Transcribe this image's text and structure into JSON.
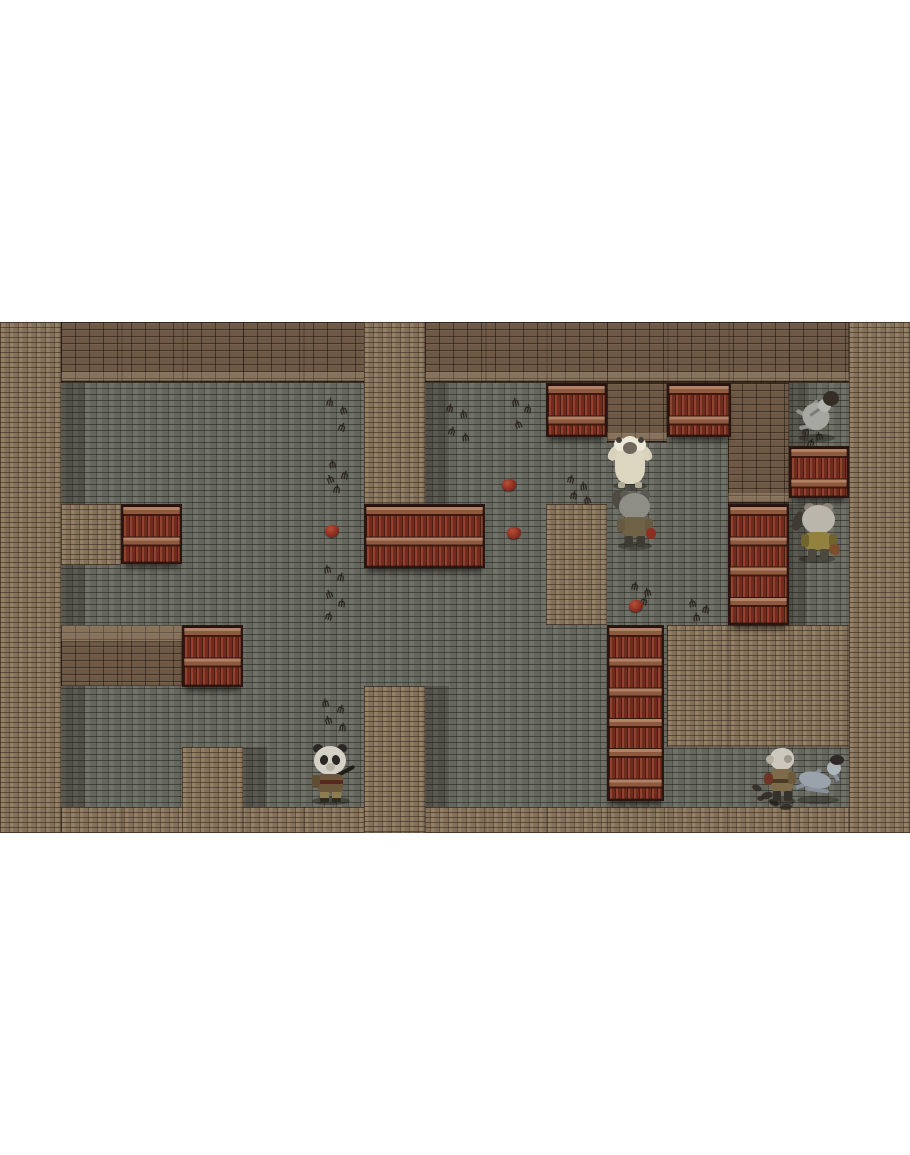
{
  "scene": {
    "letterbox_color": "#ffffff",
    "viewport": {
      "x": 0,
      "y": 322,
      "w": 910,
      "h": 511
    },
    "tile_size": 60.67
  },
  "palette": {
    "floor": "#6a6b62",
    "floor_mortar": "#45453f",
    "light_wall": "#8b775f",
    "dark_wall": "#6e5946",
    "shelf_plank": "#7e3526",
    "shelf_cap": "#b28266",
    "shelf_frame": "#2a1510",
    "blood_blob": "#8a2c1e",
    "footprint": "#27221b"
  },
  "map": {
    "tiles": [
      {
        "name": "border-left",
        "type": "light",
        "x": 0,
        "y": 0,
        "w": 60.7,
        "h": 511
      },
      {
        "name": "wall-top-band",
        "type": "dark",
        "cap": "bottom",
        "seams": true,
        "x": 60.7,
        "y": 0,
        "w": 788.6,
        "h": 60.7
      },
      {
        "name": "border-right",
        "type": "light",
        "x": 849.3,
        "y": 0,
        "w": 60.7,
        "h": 511
      },
      {
        "name": "border-bottom",
        "type": "light",
        "seams": true,
        "x": 60.7,
        "y": 485.3,
        "w": 788.6,
        "h": 25.7
      },
      {
        "name": "pillar-top-center",
        "type": "light",
        "x": 364,
        "y": 0,
        "w": 60.7,
        "h": 182
      },
      {
        "name": "wall-mid-top",
        "type": "dark",
        "cap": "bottom",
        "x": 606.7,
        "y": 60.7,
        "w": 60.7,
        "h": 60.6
      },
      {
        "name": "wall-right-top",
        "type": "dark",
        "cap": "bottom",
        "x": 728,
        "y": 60.7,
        "w": 60.7,
        "h": 121.3
      },
      {
        "name": "block-left-small",
        "type": "light",
        "x": 60.7,
        "y": 182,
        "w": 60.6,
        "h": 60.7
      },
      {
        "name": "pillar-center",
        "type": "light",
        "x": 546,
        "y": 182,
        "w": 60.7,
        "h": 121.3
      },
      {
        "name": "wall-left-band",
        "type": "dark",
        "cap": "top",
        "seams": true,
        "x": 60.7,
        "y": 303.3,
        "w": 121.3,
        "h": 60.7
      },
      {
        "name": "block-right-large",
        "type": "light",
        "seams": true,
        "x": 667.3,
        "y": 303.3,
        "w": 182,
        "h": 121.4
      },
      {
        "name": "pillar-bottom-center",
        "type": "light",
        "x": 364,
        "y": 364,
        "w": 60.7,
        "h": 147
      },
      {
        "name": "pillar-bottom-left",
        "type": "light",
        "x": 182,
        "y": 424.7,
        "w": 60.7,
        "h": 86.3
      },
      {
        "name": "shelf-top-a",
        "type": "shelf",
        "x": 546,
        "y": 60.7,
        "w": 60.7,
        "h": 54
      },
      {
        "name": "shelf-top-b",
        "type": "shelf",
        "x": 667.3,
        "y": 60.7,
        "w": 64,
        "h": 54
      },
      {
        "name": "shelf-right-corridor",
        "type": "shelf",
        "x": 788.7,
        "y": 124,
        "w": 60.6,
        "h": 52
      },
      {
        "name": "shelf-left-a",
        "type": "shelf",
        "x": 121.3,
        "y": 182,
        "w": 60.7,
        "h": 60
      },
      {
        "name": "shelf-mid-double",
        "type": "shelf",
        "x": 364,
        "y": 182,
        "w": 121.3,
        "h": 64
      },
      {
        "name": "shelf-left-b",
        "type": "shelf",
        "x": 182,
        "y": 303.3,
        "w": 60.7,
        "h": 62
      },
      {
        "name": "shelf-right-tall",
        "type": "shelf",
        "x": 728,
        "y": 182,
        "w": 60.7,
        "h": 121
      },
      {
        "name": "shelf-center-tall",
        "type": "shelf",
        "x": 606.7,
        "y": 303.3,
        "w": 57,
        "h": 176
      }
    ],
    "shadow_strips": [
      {
        "x": 60.7,
        "y": 60.7,
        "w": 24,
        "h": 424.6
      },
      {
        "x": 424.7,
        "y": 60.7,
        "w": 24,
        "h": 121.3
      },
      {
        "x": 424.7,
        "y": 364,
        "w": 24,
        "h": 147
      },
      {
        "x": 242.7,
        "y": 424.7,
        "w": 24,
        "h": 86.3
      },
      {
        "x": 788.7,
        "y": 60.7,
        "w": 20,
        "h": 63
      },
      {
        "x": 788.7,
        "y": 182,
        "w": 18,
        "h": 121
      }
    ]
  },
  "decals": {
    "footprint_glyph": "ψ",
    "footprints": [
      [
        326,
        76,
        10
      ],
      [
        340,
        84,
        -15
      ],
      [
        338,
        101,
        20
      ],
      [
        329,
        138,
        -5
      ],
      [
        341,
        149,
        15
      ],
      [
        327,
        153,
        -20
      ],
      [
        333,
        163,
        8
      ],
      [
        324,
        243,
        -10
      ],
      [
        337,
        251,
        12
      ],
      [
        326,
        268,
        -18
      ],
      [
        338,
        277,
        6
      ],
      [
        325,
        290,
        15
      ],
      [
        322,
        377,
        -8
      ],
      [
        337,
        383,
        14
      ],
      [
        325,
        394,
        -16
      ],
      [
        339,
        401,
        5
      ],
      [
        446,
        82,
        12
      ],
      [
        460,
        88,
        -10
      ],
      [
        448,
        105,
        18
      ],
      [
        462,
        111,
        -5
      ],
      [
        512,
        76,
        -12
      ],
      [
        524,
        83,
        10
      ],
      [
        515,
        98,
        -20
      ],
      [
        567,
        153,
        15
      ],
      [
        580,
        160,
        -8
      ],
      [
        570,
        169,
        12
      ],
      [
        584,
        174,
        -15
      ],
      [
        631,
        260,
        10
      ],
      [
        644,
        266,
        -12
      ],
      [
        640,
        275,
        18
      ],
      [
        689,
        277,
        -10
      ],
      [
        702,
        283,
        12
      ],
      [
        693,
        291,
        -6
      ],
      [
        802,
        105,
        8
      ],
      [
        816,
        110,
        -14
      ],
      [
        807,
        117,
        15
      ]
    ],
    "blobs": [
      [
        502,
        157
      ],
      [
        507,
        205
      ],
      [
        325,
        203
      ],
      [
        629,
        278
      ]
    ],
    "debris": [
      [
        752,
        463,
        10,
        6,
        20
      ],
      [
        761,
        470,
        12,
        7,
        -15
      ],
      [
        769,
        478,
        10,
        6,
        30
      ],
      [
        780,
        482,
        12,
        6,
        -5
      ],
      [
        757,
        474,
        7,
        5,
        0
      ]
    ]
  },
  "characters": [
    {
      "id": "sheep-monster",
      "x": 608,
      "y": 114,
      "w": 44,
      "h": 52,
      "parts": [
        {
          "n": "arm-left",
          "x": 1,
          "y": 10,
          "w": 10,
          "h": 15,
          "bg": "#d9d3bd",
          "r": "40%",
          "rot": 30
        },
        {
          "n": "arm-right",
          "x": 33,
          "y": 10,
          "w": 10,
          "h": 15,
          "bg": "#d9d3bd",
          "r": "40%",
          "rot": -30
        },
        {
          "n": "body",
          "x": 7,
          "y": 12,
          "w": 30,
          "h": 36,
          "bg": "#dcd6c0",
          "r": "34% 34% 42% 42%"
        },
        {
          "n": "mane-left",
          "x": 6,
          "y": 2,
          "w": 13,
          "h": 13,
          "bg": "#ece8d8",
          "r": "50%"
        },
        {
          "n": "mane-right",
          "x": 25,
          "y": 2,
          "w": 13,
          "h": 13,
          "bg": "#ece8d8",
          "r": "50%"
        },
        {
          "n": "mane-top",
          "x": 14,
          "y": 0,
          "w": 16,
          "h": 14,
          "bg": "#ece8d8",
          "r": "50%"
        },
        {
          "n": "ear-left",
          "x": 8,
          "y": 1,
          "w": 6,
          "h": 6,
          "bg": "#44403a",
          "r": "50%"
        },
        {
          "n": "ear-right",
          "x": 30,
          "y": 1,
          "w": 6,
          "h": 6,
          "bg": "#44403a",
          "r": "50%"
        },
        {
          "n": "face",
          "x": 15,
          "y": 6,
          "w": 14,
          "h": 12,
          "bg": "#6f665c",
          "r": "50%"
        },
        {
          "n": "foot-left",
          "x": 10,
          "y": 46,
          "w": 7,
          "h": 6,
          "bg": "#b3ac96",
          "r": "30%"
        },
        {
          "n": "foot-right",
          "x": 27,
          "y": 46,
          "w": 7,
          "h": 6,
          "bg": "#b3ac96",
          "r": "30%"
        }
      ]
    },
    {
      "id": "cat-villager-front",
      "x": 612,
      "y": 168,
      "w": 46,
      "h": 58,
      "parts": [
        {
          "n": "tail",
          "x": 0,
          "y": 0,
          "w": 15,
          "h": 20,
          "bg": "#4f4b42",
          "r": "50%",
          "rot": -20
        },
        {
          "n": "ear-left",
          "x": 8,
          "y": 0,
          "w": 10,
          "h": 10,
          "bg": "#5b5a52",
          "r": "50%"
        },
        {
          "n": "ear-right",
          "x": 28,
          "y": 0,
          "w": 10,
          "h": 10,
          "bg": "#5b5a52",
          "r": "50%"
        },
        {
          "n": "head",
          "x": 7,
          "y": 3,
          "w": 31,
          "h": 27,
          "bg": "#8e8d86",
          "r": "50%"
        },
        {
          "n": "body",
          "x": 10,
          "y": 27,
          "w": 26,
          "h": 20,
          "bg": "#6f6246",
          "r": "28%"
        },
        {
          "n": "arm-left",
          "x": 5,
          "y": 29,
          "w": 8,
          "h": 13,
          "bg": "#665a40",
          "r": "30%"
        },
        {
          "n": "arm-right",
          "x": 33,
          "y": 29,
          "w": 8,
          "h": 13,
          "bg": "#665a40",
          "r": "30%"
        },
        {
          "n": "pouch",
          "x": 34,
          "y": 38,
          "w": 10,
          "h": 11,
          "bg": "#8c3024",
          "r": "45%"
        },
        {
          "n": "leg-left",
          "x": 13,
          "y": 46,
          "w": 8,
          "h": 11,
          "bg": "#3e3b34",
          "r": "20%"
        },
        {
          "n": "leg-right",
          "x": 25,
          "y": 46,
          "w": 8,
          "h": 11,
          "bg": "#3e3b34",
          "r": "20%"
        }
      ]
    },
    {
      "id": "skeleton-north",
      "x": 793,
      "y": 68,
      "w": 48,
      "h": 50,
      "parts": [
        {
          "n": "limb-a",
          "x": 2,
          "y": 24,
          "w": 24,
          "h": 4,
          "bg": "#8f918b",
          "rot": 28,
          "r": "2px"
        },
        {
          "n": "limb-b",
          "x": 6,
          "y": 34,
          "w": 22,
          "h": 4,
          "bg": "#8f918b",
          "rot": -12,
          "r": "2px"
        },
        {
          "n": "limb-c",
          "x": 16,
          "y": 8,
          "w": 4,
          "h": 20,
          "bg": "#8f918b",
          "rot": 40,
          "r": "2px"
        },
        {
          "n": "body",
          "x": 10,
          "y": 13,
          "w": 26,
          "h": 27,
          "bg": "#a6a7a1",
          "r": "46%",
          "rot": -35
        },
        {
          "n": "rib-shade",
          "x": 16,
          "y": 20,
          "w": 14,
          "h": 3,
          "bg": "#7c7e78",
          "rot": -35
        },
        {
          "n": "skull",
          "x": 25,
          "y": 9,
          "w": 13,
          "h": 13,
          "bg": "#b4b4ae",
          "r": "50%"
        },
        {
          "n": "hair",
          "x": 30,
          "y": 1,
          "w": 16,
          "h": 15,
          "bg": "#362d27",
          "r": "50%"
        }
      ]
    },
    {
      "id": "cat-villager-east",
      "x": 793,
      "y": 181,
      "w": 48,
      "h": 58,
      "parts": [
        {
          "n": "tail",
          "x": 0,
          "y": 8,
          "w": 10,
          "h": 20,
          "bg": "#3f3b33",
          "r": "50%",
          "rot": 18
        },
        {
          "n": "ear-left",
          "x": 11,
          "y": 0,
          "w": 11,
          "h": 9,
          "bg": "#8b8378",
          "r": "50%"
        },
        {
          "n": "ear-right",
          "x": 29,
          "y": 0,
          "w": 11,
          "h": 9,
          "bg": "#8b8378",
          "r": "50%"
        },
        {
          "n": "head",
          "x": 9,
          "y": 2,
          "w": 33,
          "h": 29,
          "bg": "#bab6ac",
          "r": "50%"
        },
        {
          "n": "body",
          "x": 12,
          "y": 29,
          "w": 27,
          "h": 18,
          "bg": "#93813f",
          "r": "26%"
        },
        {
          "n": "arm-left",
          "x": 8,
          "y": 31,
          "w": 8,
          "h": 13,
          "bg": "#6f6330",
          "r": "30%"
        },
        {
          "n": "arm-right",
          "x": 36,
          "y": 31,
          "w": 8,
          "h": 13,
          "bg": "#6f6330",
          "r": "30%"
        },
        {
          "n": "pouch",
          "x": 36,
          "y": 41,
          "w": 11,
          "h": 11,
          "bg": "#7c4e2c",
          "r": "45%"
        },
        {
          "n": "leg-left",
          "x": 15,
          "y": 46,
          "w": 8,
          "h": 11,
          "bg": "#4c4840",
          "r": "20%"
        },
        {
          "n": "leg-right",
          "x": 27,
          "y": 46,
          "w": 8,
          "h": 11,
          "bg": "#4c4840",
          "r": "20%"
        }
      ]
    },
    {
      "id": "panda-gunner",
      "x": 306,
      "y": 422,
      "w": 50,
      "h": 59,
      "parts": [
        {
          "n": "ear-left",
          "x": 7,
          "y": 0,
          "w": 10,
          "h": 9,
          "bg": "#2b2724",
          "r": "50%"
        },
        {
          "n": "ear-right",
          "x": 31,
          "y": 0,
          "w": 10,
          "h": 9,
          "bg": "#2b2724",
          "r": "50%"
        },
        {
          "n": "head",
          "x": 8,
          "y": 2,
          "w": 32,
          "h": 29,
          "bg": "#d6d1c6",
          "r": "50%"
        },
        {
          "n": "eye-left",
          "x": 14,
          "y": 11,
          "w": 8,
          "h": 10,
          "bg": "#2b2724",
          "r": "50%",
          "rot": 12
        },
        {
          "n": "eye-right",
          "x": 26,
          "y": 11,
          "w": 8,
          "h": 10,
          "bg": "#2b2724",
          "r": "50%",
          "rot": -12
        },
        {
          "n": "muzzle",
          "x": 20,
          "y": 19,
          "w": 9,
          "h": 8,
          "bg": "#b9b3a6",
          "r": "50%"
        },
        {
          "n": "gun",
          "x": 22,
          "y": 27,
          "w": 28,
          "h": 4,
          "bg": "#201d19",
          "rot": -28,
          "r": "2px"
        },
        {
          "n": "body",
          "x": 12,
          "y": 30,
          "w": 25,
          "h": 19,
          "bg": "#6b583c",
          "r": "22%"
        },
        {
          "n": "strap",
          "x": 12,
          "y": 36,
          "w": 25,
          "h": 4,
          "bg": "#59281f"
        },
        {
          "n": "arm-left",
          "x": 6,
          "y": 31,
          "w": 8,
          "h": 13,
          "bg": "#5f4e34",
          "r": "30%"
        },
        {
          "n": "leg-left",
          "x": 14,
          "y": 48,
          "w": 9,
          "h": 7,
          "bg": "#8d7b51"
        },
        {
          "n": "leg-right",
          "x": 26,
          "y": 48,
          "w": 9,
          "h": 7,
          "bg": "#8d7b51"
        },
        {
          "n": "boot-left",
          "x": 14,
          "y": 54,
          "w": 9,
          "h": 5,
          "bg": "#2e2a26"
        },
        {
          "n": "boot-right",
          "x": 26,
          "y": 54,
          "w": 9,
          "h": 5,
          "bg": "#2e2a26"
        }
      ]
    },
    {
      "id": "goat-warrior",
      "x": 764,
      "y": 426,
      "w": 36,
      "h": 55,
      "parts": [
        {
          "n": "head",
          "x": 6,
          "y": 0,
          "w": 24,
          "h": 22,
          "bg": "#ccc8bd",
          "r": "46%"
        },
        {
          "n": "mane",
          "x": 2,
          "y": 7,
          "w": 8,
          "h": 9,
          "bg": "#b5b0a2",
          "r": "50%"
        },
        {
          "n": "face-shade",
          "x": 20,
          "y": 7,
          "w": 8,
          "h": 8,
          "bg": "#9d988c",
          "r": "50%"
        },
        {
          "n": "body",
          "x": 7,
          "y": 21,
          "w": 22,
          "h": 23,
          "bg": "#7e6b49",
          "r": "22%"
        },
        {
          "n": "belt",
          "x": 7,
          "y": 31,
          "w": 22,
          "h": 4,
          "bg": "#4a3a28"
        },
        {
          "n": "item",
          "x": 0,
          "y": 25,
          "w": 9,
          "h": 12,
          "bg": "#6e3526",
          "r": "40%"
        },
        {
          "n": "arm-right",
          "x": 24,
          "y": 24,
          "w": 8,
          "h": 12,
          "bg": "#6b5a3c",
          "r": "30%"
        },
        {
          "n": "leg-left",
          "x": 9,
          "y": 43,
          "w": 8,
          "h": 10,
          "bg": "#35312b",
          "r": "15%"
        },
        {
          "n": "leg-right",
          "x": 20,
          "y": 43,
          "w": 8,
          "h": 10,
          "bg": "#35312b",
          "r": "15%"
        }
      ]
    },
    {
      "id": "skeleton-south",
      "x": 791,
      "y": 432,
      "w": 54,
      "h": 48,
      "parts": [
        {
          "n": "limb-a",
          "x": 4,
          "y": 28,
          "w": 24,
          "h": 4,
          "bg": "#87909a",
          "rot": -18,
          "r": "2px"
        },
        {
          "n": "limb-b",
          "x": 14,
          "y": 34,
          "w": 24,
          "h": 4,
          "bg": "#87909a",
          "rot": 8,
          "r": "2px"
        },
        {
          "n": "limb-c",
          "x": 20,
          "y": 12,
          "w": 4,
          "h": 20,
          "bg": "#87909a",
          "rot": 50,
          "r": "2px"
        },
        {
          "n": "body",
          "x": 8,
          "y": 18,
          "w": 32,
          "h": 16,
          "bg": "#9aa3ab",
          "r": "46%",
          "rot": 10
        },
        {
          "n": "arm-up",
          "x": 42,
          "y": 14,
          "w": 4,
          "h": 14,
          "bg": "#87909a",
          "rot": -30,
          "r": "2px"
        },
        {
          "n": "skull",
          "x": 36,
          "y": 7,
          "w": 14,
          "h": 14,
          "bg": "#aeb6bd",
          "r": "50%"
        },
        {
          "n": "cap",
          "x": 39,
          "y": 1,
          "w": 14,
          "h": 10,
          "bg": "#2e2926",
          "r": "50%"
        }
      ]
    }
  ]
}
